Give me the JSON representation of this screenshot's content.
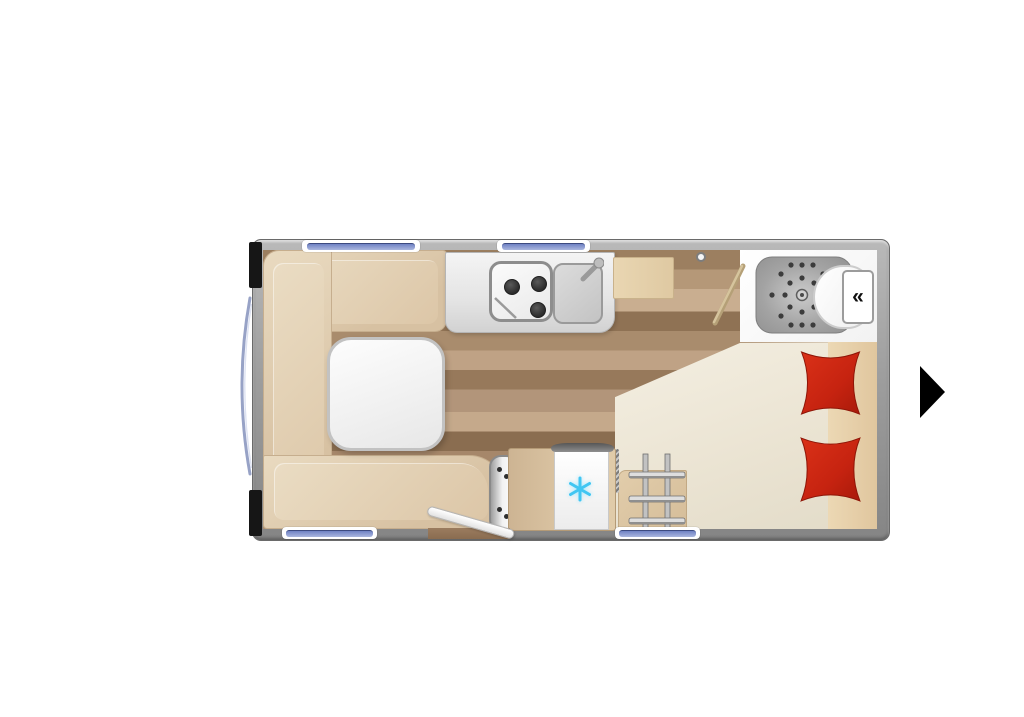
{
  "title": "Caravan floor plan – top view",
  "navigation": {
    "next_arrow_icon": "black-right-triangle"
  },
  "bathroom": {
    "service_hatch_glyph": "«",
    "fixtures": [
      "shower-tray",
      "shower-drain",
      "toilet",
      "bathroom-door-open"
    ]
  },
  "kitchen": {
    "burner_count": "3",
    "fixtures": [
      "kitchen-counter",
      "stove-3-burner",
      "sink",
      "faucet",
      "overhead-cabinet"
    ]
  },
  "lounge": {
    "fixtures": [
      "u-shaped-dinette",
      "dinette-table"
    ]
  },
  "bedroom": {
    "pillow_count": "2",
    "fixtures": [
      "french-bed",
      "red-pillows",
      "bunk-ladder",
      "bedside-cabinet"
    ]
  },
  "appliances": [
    "refrigerator-with-snowflake",
    "heater"
  ],
  "openings": [
    "entry-door-open",
    "front-panorama-window",
    "top-window-left",
    "top-window-right",
    "bottom-window-left",
    "bottom-window-right"
  ],
  "colors": {
    "wall_gray": "#9a9a9a",
    "upholstery_beige": "#ddc7a9",
    "mattress_cream": "#eee8d8",
    "pillow_red": "#c62610",
    "window_blue": "#7e90cf",
    "snowflake_cyan": "#41c6f2",
    "floor_wood": "#a98c6d",
    "arrow_black": "#000000"
  }
}
